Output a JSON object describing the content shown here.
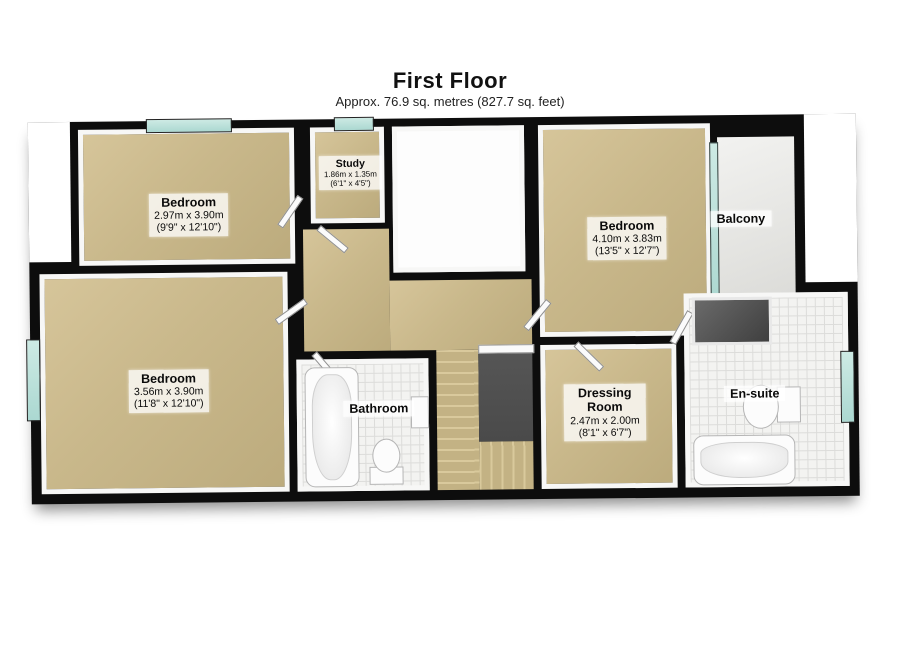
{
  "header": {
    "title": "First Floor",
    "subtitle": "Approx. 76.9 sq. metres (827.7 sq. feet)"
  },
  "rooms": {
    "bedroom_top_left": {
      "name": "Bedroom",
      "metric": "2.97m x 3.90m",
      "imperial": "(9'9\" x 12'10\")"
    },
    "study": {
      "name": "Study",
      "metric": "1.86m x 1.35m",
      "imperial": "(6'1\" x 4'5\")"
    },
    "bedroom_top_right": {
      "name": "Bedroom",
      "metric": "4.10m x 3.83m",
      "imperial": "(13'5\" x 12'7\")"
    },
    "balcony": {
      "name": "Balcony"
    },
    "bedroom_bottom_left": {
      "name": "Bedroom",
      "metric": "3.56m x 3.90m",
      "imperial": "(11'8\" x 12'10\")"
    },
    "bathroom": {
      "name": "Bathroom"
    },
    "dressing_room": {
      "name": "Dressing Room",
      "metric": "2.47m x 2.00m",
      "imperial": "(8'1\" x 6'7\")"
    },
    "ensuite": {
      "name": "En-suite"
    }
  },
  "colors": {
    "wall": "#0d0d0d",
    "carpet": "#c9b88b",
    "tile": "#f3f3f1",
    "window_glass": "#b9ded7",
    "stair_void": "#4e4e4e",
    "balcony_floor": "#e6e6e3"
  }
}
